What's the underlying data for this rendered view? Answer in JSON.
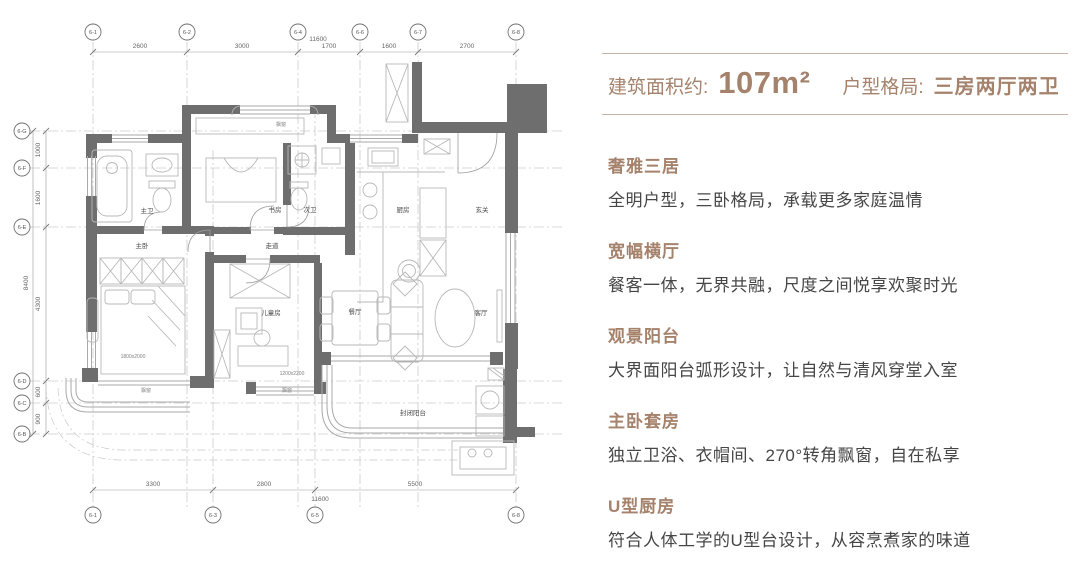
{
  "colors": {
    "accent": "#a5826b",
    "header_line": "#c7b3a5",
    "body_text": "#464646",
    "wall": "#6e6e6e"
  },
  "header": {
    "area_label": "建筑面积约:",
    "area_value": "107m²",
    "layout_label": "户型格局:",
    "layout_value": "三房两厅两卫"
  },
  "features": [
    {
      "title": "奢雅三居",
      "desc": "全明户型，三卧格局，承载更多家庭温情"
    },
    {
      "title": "宽幅横厅",
      "desc": "餐客一体，无界共融，尺度之间悦享欢聚时光"
    },
    {
      "title": "观景阳台",
      "desc": "大界面阳台弧形设计，让自然与清风穿堂入室"
    },
    {
      "title": "主卧套房",
      "desc": "独立卫浴、衣帽间、270°转角飘窗，自在私享"
    },
    {
      "title": "U型厨房",
      "desc": "符合人体工学的U型台设计，从容烹煮家的味道"
    }
  ],
  "floorplan": {
    "grid_top": [
      "6-1",
      "6-2",
      "6-4",
      "6-6",
      "6-7",
      "6-8"
    ],
    "dims_top": [
      "2600",
      "3000",
      "1700",
      "1600",
      "2700"
    ],
    "total_width": "11600",
    "grid_left": [
      "6-G",
      "6-F",
      "6-E",
      "6-D",
      "6-C",
      "6-B"
    ],
    "dims_left": [
      "1000",
      "1600",
      "4300",
      "600",
      "900"
    ],
    "total_height": "8400",
    "grid_bottom": [
      "6-1",
      "6-3",
      "6-5",
      "6-8"
    ],
    "dims_bottom": [
      "3300",
      "2800",
      "5500"
    ],
    "rooms": {
      "master_bath": "主卫",
      "study": "书房",
      "second_bath": "次卫",
      "kitchen": "厨房",
      "foyer": "玄关",
      "master_bed": "主卧",
      "corridor": "走道",
      "kids": "儿童房",
      "dining": "餐厅",
      "living": "客厅",
      "balcony": "封闭阳台",
      "bay_window": "飘窗",
      "bed_size": "1800x2000",
      "bay_size": "1200x2200"
    }
  }
}
